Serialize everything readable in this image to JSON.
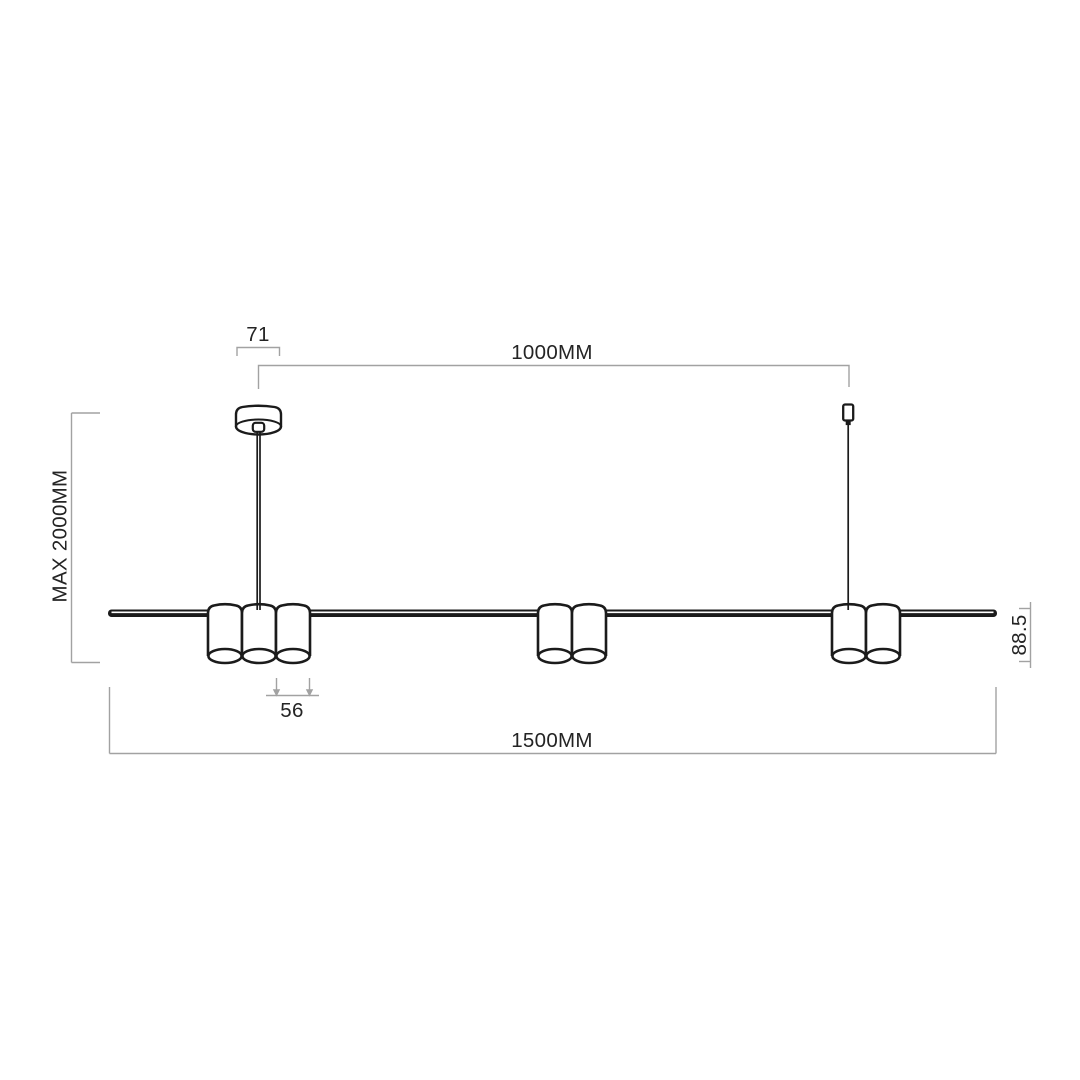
{
  "drawing": {
    "type": "pendant-lamp-dimension-diagram",
    "dimensions": {
      "canopy_width": "71",
      "suspension_span": "1000MM",
      "max_drop": "MAX 2000MM",
      "spot_height": "88.5",
      "spot_diameter": "56",
      "fixture_length": "1500MM"
    },
    "colors": {
      "ink": "#1b1b1b",
      "dimension_line": "#a2a2a2",
      "text": "#242424",
      "background": "#ffffff"
    }
  }
}
